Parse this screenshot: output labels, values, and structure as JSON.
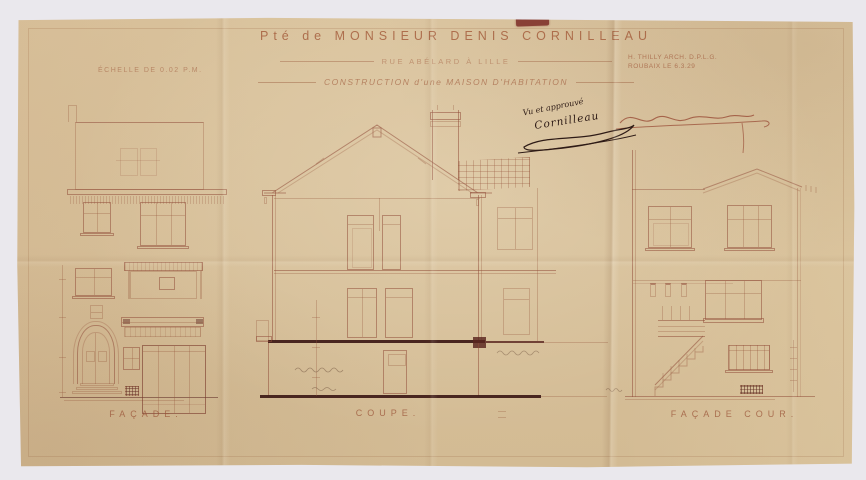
{
  "sheet": {
    "title": {
      "line1": "Pté de MONSIEUR DENIS CORNILLEAU",
      "line2": "RUE ABÉLARD À LILLE",
      "line3": "CONSTRUCTION d'une MAISON D'HABITATION"
    },
    "scale_note": "ÉCHELLE DE 0.02 P.M.",
    "architect": {
      "line1": "H. THILLY  ARCH. D.P.L.G.",
      "line2": "ROUBAIX LE 6.3.29"
    },
    "approval": {
      "note": "Vu et approuvé",
      "signature": "Cornilleau"
    },
    "drawing_labels": {
      "facade": "FAÇADE.",
      "coupe": "COUPE.",
      "facade_cour": "FAÇADE COUR."
    },
    "colors": {
      "paper": "#d8c09a",
      "line_sepia": "#8f4a38",
      "ink_dark": "#33201b",
      "stamp_red": "#7c2a25",
      "background": "#eae8ed"
    }
  }
}
